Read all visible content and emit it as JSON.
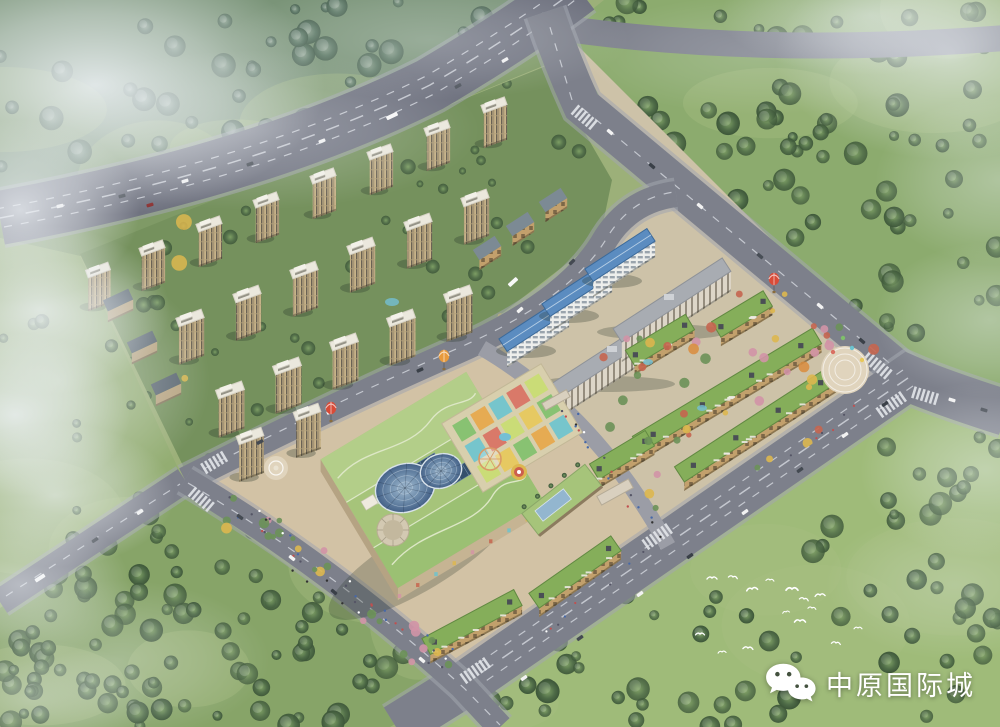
{
  "watermark": {
    "brand_label": "中原国际城",
    "icon": "wechat-icon",
    "text_color": "#ffffff"
  },
  "scene": {
    "type": "aerial-architectural-rendering",
    "elements": [
      "residential-towers",
      "office-buildings",
      "shopping-street-buildings",
      "shopping-mall",
      "glass-domes",
      "rooftop-playground",
      "roads",
      "forest",
      "mist-clouds",
      "birds",
      "hot-air-balloons"
    ]
  },
  "palette": {
    "sky_haze": "#c3cfdc",
    "mist": "#eef2f6",
    "forest_nw": "#72907b",
    "tree_nw": "#5a7664",
    "tree_nw_hi": "#8ba08e",
    "meadow_ne": "#8cab6e",
    "tree_ne": "#5f7f52",
    "meadow_se": "#9fbb79",
    "tree_se": "#647f4f",
    "meadow_sw": "#87a468",
    "tree_sw": "#4f6a49",
    "road": "#7d808b",
    "road_dark": "#707380",
    "lane": "#d0d4db",
    "sidewalk": "#a2a5ae",
    "residential_ground": "#75915d",
    "tree_green": "#4e6b47",
    "tree_yellow": "#ddb74f",
    "tree_orange": "#d98f43",
    "tree_red": "#c5654f",
    "tree_pink": "#d294a6",
    "tower_wall": "#c7b388",
    "tower_wall_dark": "#6a6254",
    "tower_side": "#a8966f",
    "tower_roof": "#ebe8dd",
    "office_wall": "#edeeec",
    "office_roof": "#5b8cc0",
    "slab_wall": "#ddd6c8",
    "slab_roof": "#a8acb2",
    "shop_wall": "#c2a06c",
    "shop_roof": "#85ae5a",
    "shop_roof_edge": "#6b9349",
    "mall_roof": "#a6c47a",
    "mall_roof_light": "#b3ce89",
    "mall_roof_dark": "#9bc073",
    "mall_wall": "#c6b493",
    "mall_path": "#dde7c6",
    "dome_hi": "#a3bcd1",
    "dome_lo": "#446187",
    "solar": "#34506c",
    "plaza": "#d2c2a5",
    "plaza_light": "#e0d4bd",
    "balloon_red": "#d84b38",
    "balloon_orange": "#e89a3c",
    "water": "#74bfd4",
    "bird": "#ffffff",
    "watermark_text": "#ffffff"
  }
}
